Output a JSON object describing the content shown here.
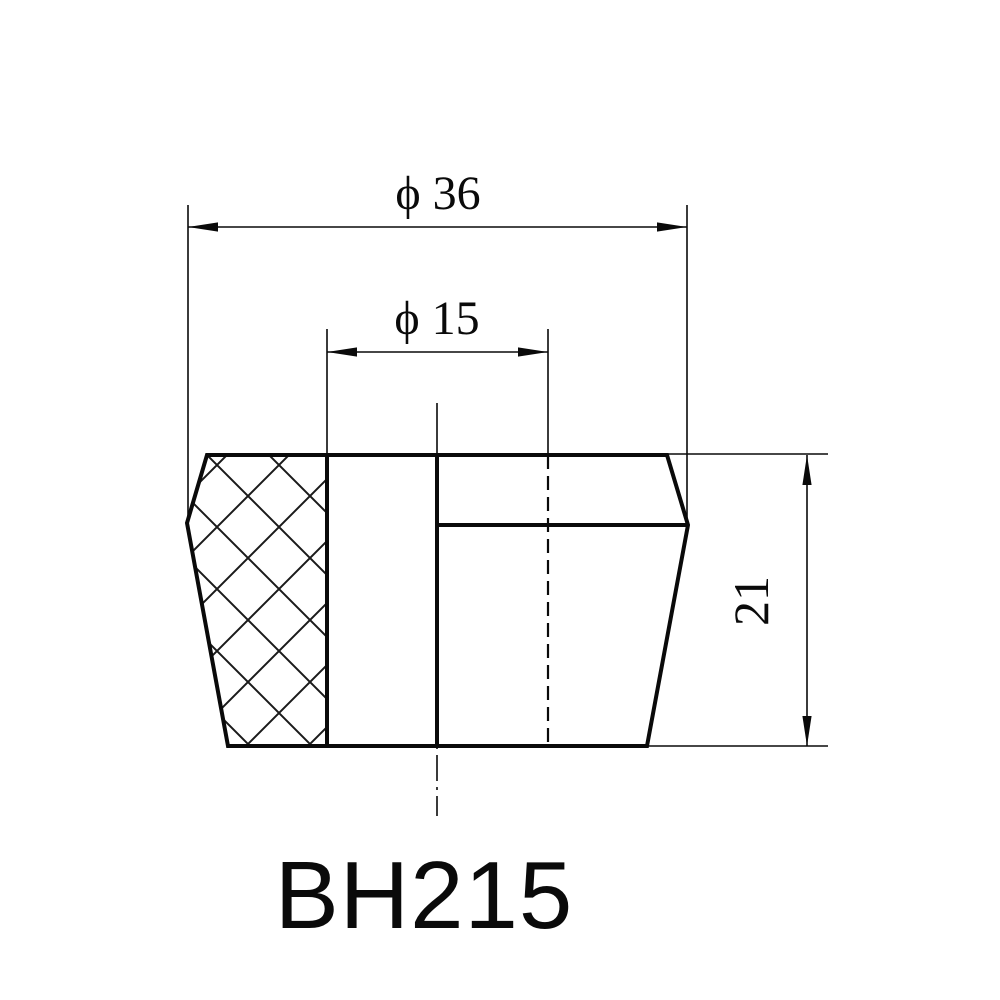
{
  "drawing": {
    "part_number": "BH215",
    "dimensions": {
      "outer_diameter_label": "ϕ 36",
      "bore_diameter_label": "ϕ 15",
      "height_label": "21"
    },
    "colors": {
      "line": "#0a0a0a",
      "background": "#ffffff"
    }
  }
}
